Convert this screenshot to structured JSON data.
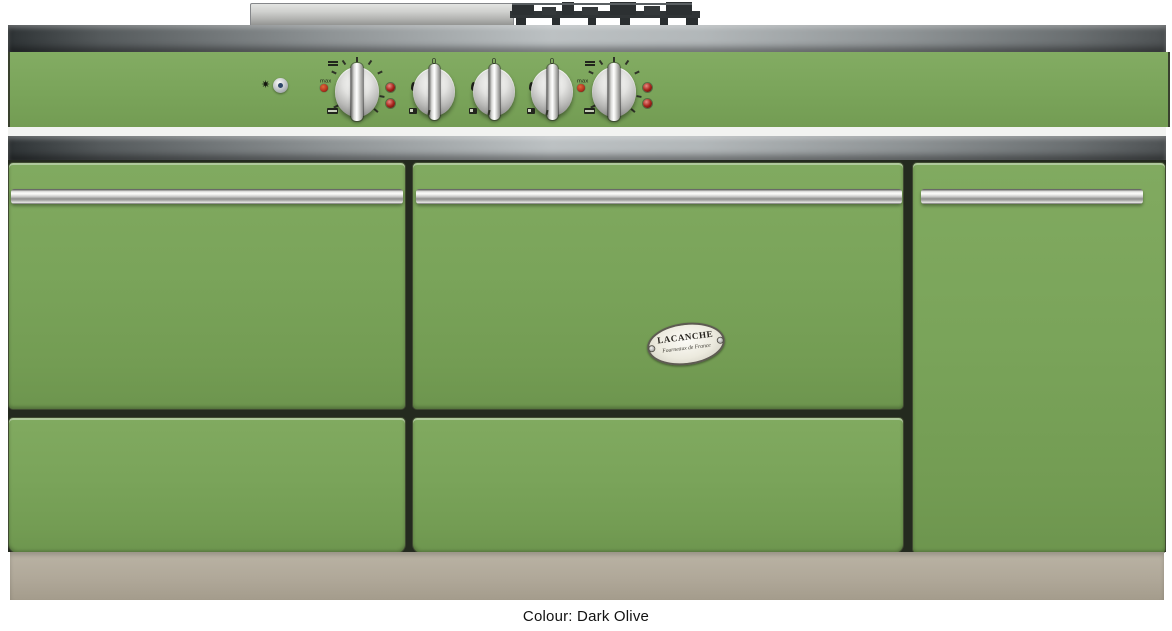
{
  "product": {
    "caption": "Colour: Dark Olive"
  },
  "badge": {
    "title": "LACANCHE",
    "subtitle": "Fourneaux de France"
  },
  "colors": {
    "body_green": "#7aa45a",
    "plinth_beige": "#b0a899",
    "trim_steel_light": "#bcc1c3",
    "trim_steel_dark": "#2e3335",
    "grate_black": "#303436",
    "indicator_red": "#a8231c",
    "pilot_orange_red": "#b5341f",
    "ignition_blue": "#2d4668"
  },
  "control_panel": {
    "labels": {
      "max": "max",
      "zero": "0"
    },
    "knobs": [
      {
        "id": "left-oven-thermostat-knob",
        "type": "oven"
      },
      {
        "id": "gas-burner-knob-1",
        "type": "gas-burner"
      },
      {
        "id": "gas-burner-knob-2",
        "type": "gas-burner"
      },
      {
        "id": "gas-burner-knob-3",
        "type": "gas-burner"
      },
      {
        "id": "right-oven-thermostat-knob",
        "type": "oven"
      }
    ],
    "icons": [
      "spark-icon",
      "ignition-button",
      "flame-icon",
      "grill-icon",
      "oven-solid-icon",
      "burner-position-icon",
      "indicator-lamp",
      "pilot-dot"
    ]
  },
  "sections": {
    "top": [
      "stainless-lid",
      "pan-support-grates"
    ],
    "doors": [
      "left-oven-door",
      "central-oven-door",
      "right-tall-door"
    ],
    "drawers": [
      "left-storage-drawer",
      "central-storage-drawer"
    ]
  }
}
